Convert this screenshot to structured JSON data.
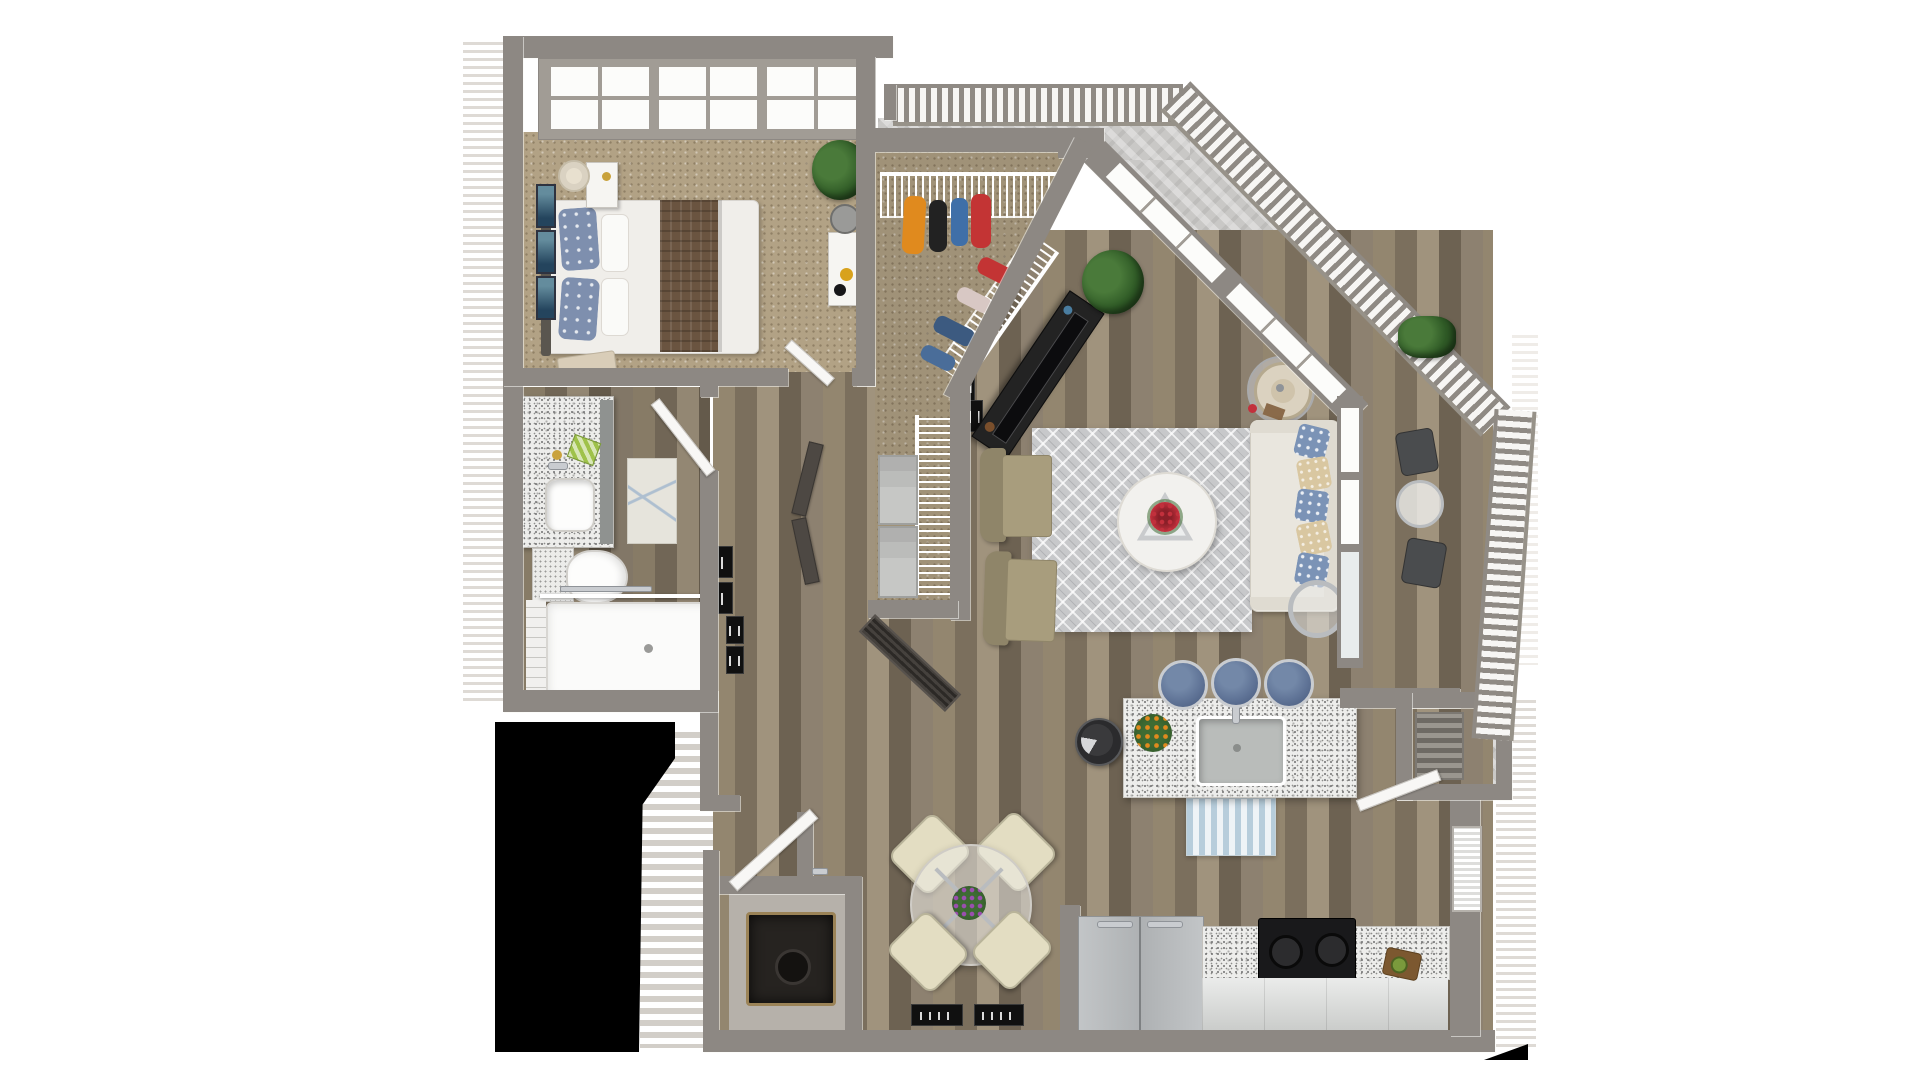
{
  "scene": {
    "kind": "3d-floor-plan-render",
    "view": "top-down dollhouse",
    "unit": "one-bedroom apartment with balcony",
    "background": "#ffffff",
    "visible_text": ""
  },
  "palette": {
    "wall": "#8d8883",
    "wood_floor": "#867a68",
    "carpet": "#b2a285",
    "balcony_concrete": "#c9c8c6",
    "granite": "#ededeb",
    "area_rug": "#c7c8ca",
    "mask": "#000000",
    "sofa": "#e9e6de",
    "pillow_blue": "#7b93b6",
    "pillow_tan": "#d9c7a1",
    "stool_blue": "#5f7396",
    "dining_chair": "#e3ddc2",
    "armchair_olive": "#968c6d",
    "bed_throw": "#6a5440",
    "clothes": [
      "#e08a1e",
      "#222222",
      "#3f6fa8",
      "#c33434"
    ],
    "flowers_red": "#c2303c",
    "flowers_purple": "#9a4fae",
    "flowers_orange": "#e08a1e"
  },
  "rooms": [
    {
      "name": "bedroom",
      "floor": "carpet",
      "furniture": [
        "bed with brown throw",
        "patterned pillows",
        "headboard",
        "nightstand with lamp",
        "bench",
        "white desk with bin",
        "potted plant",
        "three wall art frames",
        "divided-light window wall"
      ]
    },
    {
      "name": "walk-in-closet",
      "floor": "carpet",
      "furniture": [
        "wire shelving",
        "hanging clothes",
        "diagonal wire shelf"
      ]
    },
    {
      "name": "laundry-closet",
      "floor": "carpet",
      "furniture": [
        "wire shelf",
        "two storage baskets",
        "louvered bifold door"
      ]
    },
    {
      "name": "bathroom",
      "floor": "wood",
      "furniture": [
        "granite vanity with sink",
        "lighted mirror",
        "toilet",
        "star-pattern rug",
        "walk-in shower with glass panel"
      ]
    },
    {
      "name": "hallway-entry",
      "floor": "wood",
      "furniture": [
        "black gallery frames",
        "open doors",
        "front door"
      ]
    },
    {
      "name": "living-room",
      "floor": "wood",
      "furniture": [
        "black tv console with tv",
        "corner windows",
        "cream sofa with ikat pillows",
        "drum-shade lamp table",
        "ring side table",
        "diamond rug",
        "round coffee table with red flowers",
        "two olive armchairs",
        "potted plant"
      ]
    },
    {
      "name": "kitchen",
      "floor": "wood",
      "furniture": [
        "granite island with sink and faucet",
        "three blue bar stools",
        "orange flower vase",
        "robot vacuum",
        "striped runner rug",
        "stainless fridge",
        "black range",
        "granite counters",
        "cutting board with avocado",
        "window with blinds"
      ]
    },
    {
      "name": "dining-area",
      "floor": "wood",
      "furniture": [
        "round glass table",
        "four cream chairs",
        "purple centerpiece",
        "two black wall frames"
      ]
    },
    {
      "name": "utility-closet",
      "floor": "concrete",
      "furniture": [
        "water heater"
      ]
    },
    {
      "name": "balcony",
      "floor": "concrete",
      "furniture": [
        "metal railing",
        "bistro table",
        "two patio chairs",
        "shrub",
        "storage closet with shelf"
      ]
    },
    {
      "name": "exterior",
      "floor": "none",
      "furniture": [
        "entry stairs",
        "siding hatch",
        "blacked-out area"
      ]
    }
  ]
}
